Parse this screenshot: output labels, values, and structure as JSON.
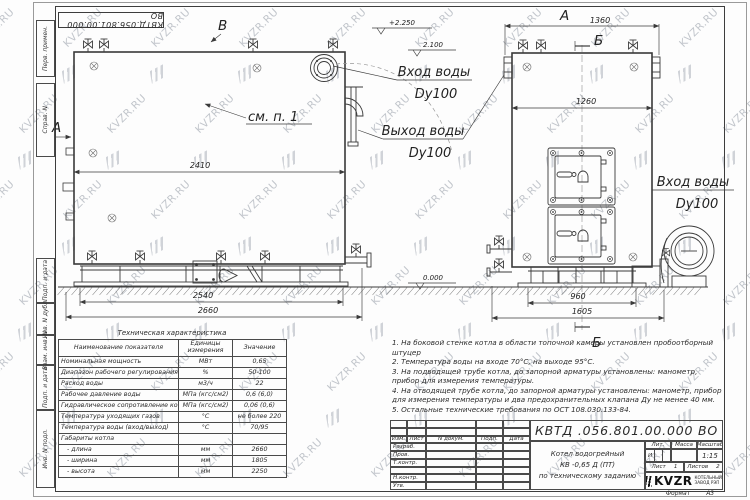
{
  "watermark": {
    "text": "KVZR.RU"
  },
  "stamp_top": "КВТД.056.801.00.000  ВО",
  "margin_stamps": {
    "top": [
      "Перв. примен.",
      "Справ. N"
    ],
    "bottom": [
      "Подп. и дата",
      "Инв. N дубл.",
      "Взам. инв. N",
      "Подп. и дата",
      "Инв. N подл."
    ]
  },
  "views": {
    "side": {
      "label_a": "А",
      "label_b": "В",
      "see_note": "см. п. 1",
      "dim_inner": "2410",
      "dim_base": "2540",
      "dim_total": "2660",
      "inlet_label": "Вход воды",
      "inlet_dn": "Dy100",
      "outlet_label": "Выход воды",
      "outlet_dn": "Dy100",
      "elev_top": "+2.250",
      "elev_mid": "2.100",
      "elev_zero": "0.000"
    },
    "front": {
      "label_a": "А",
      "label_b_top": "Б",
      "label_b_bottom": "Б",
      "dim_top": "1360",
      "dim_inner": "1260",
      "dim_base": "960",
      "dim_total": "1605",
      "inlet_label": "Вход воды",
      "inlet_dn": "Dy100"
    }
  },
  "tech_table": {
    "title": "Техническая характеристика",
    "headers": [
      "Наименование показателя",
      "Единицы измерения",
      "Значение"
    ],
    "rows": [
      [
        "Номинальная мощность",
        "МВт",
        "0,65"
      ],
      [
        "Диапазон рабочего регулирования",
        "%",
        "50-100"
      ],
      [
        "Расход воды",
        "м3/ч",
        "22"
      ],
      [
        "Рабочее давление воды",
        "МПа (кгс/см2)",
        "0,6 (6,0)"
      ],
      [
        "Гидравлическое сопротивление котла",
        "МПа (кгс/см2)",
        "0,06 (0,6)"
      ],
      [
        "Температура уходящих газов",
        "°С",
        "не более 220"
      ],
      [
        "Температура воды (вход/выход)",
        "°С",
        "70/95"
      ],
      [
        "Габариты котла",
        "",
        ""
      ],
      [
        "   - длина",
        "мм",
        "2660"
      ],
      [
        "   - ширина",
        "мм",
        "1805"
      ],
      [
        "   - высота",
        "мм",
        "2250"
      ]
    ]
  },
  "notes": {
    "lines": [
      "1.  На боковой стенке котла в области топочной камеры установлен пробоотборный штуцер",
      "2.  Температура воды на входе  70°С, на выходе  95°С.",
      "3.  На подводящей трубе котла, до запорной арматуры установлены: манометр, прибор для измерения температуры.",
      "4.  На отводящей трубе котла, до запорной арматуры установлены: манометр, прибор для измерения температуры и два предохранительных клапана  Ду не менее  40 мм.",
      "5.  Остальные технические требования по ОСТ  108.030.133-84."
    ]
  },
  "title_block": {
    "doc_number": "КВТД .056.801.00.000  ВО",
    "product_name_lines": [
      "Котел водогрейный",
      "КВ -0,65  Д  (ПТ)",
      "по техническому заданию"
    ],
    "header_cols": [
      "Изм.",
      "Лист",
      "N докум.",
      "Подп.",
      "Дата"
    ],
    "row_labels": [
      "Разраб.",
      "Пров.",
      "Т.контр.",
      "",
      "Н.контр.",
      "Утв."
    ],
    "lit_label": "Лит.",
    "lit_value": "И",
    "mass_label": "Масса",
    "scale_label": "Масштаб",
    "scale_value": "1:15",
    "sheet_label": "Лист",
    "sheet_value": "1",
    "sheets_label": "Листов",
    "sheets_value": "2",
    "company_logo": "KVZR",
    "company_name_1": "КОТЕЛЬНЫЙ",
    "company_name_2": "ЗАВОД РЭП",
    "format_label": "Формат",
    "format_value": "А3"
  }
}
